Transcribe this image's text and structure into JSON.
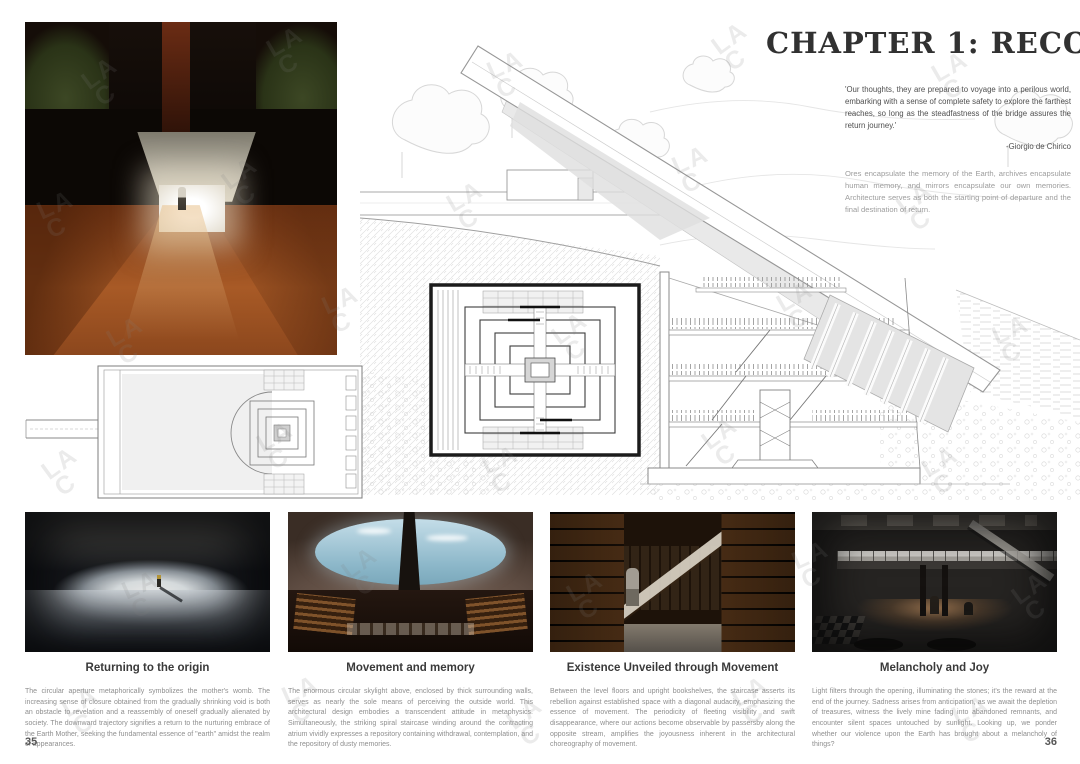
{
  "header": {
    "title": "CHAPTER 1: RECORD",
    "quote": "'Our thoughts, they are prepared to voyage into a perilous world, embarking with a sense of complete safety to explore the farthest reaches, so long as the steadfastness of the bridge assures the return journey.'",
    "attribution": "-Giorgio de Chirico",
    "intro": "Ores encapsulate the memory of the Earth, archives encapsulate human memory, and mirrors encapsulate our own memories. Architecture serves as both the starting point of departure and the final destination of return."
  },
  "watermark": {
    "line1": "LA",
    "line2": "C"
  },
  "pages": {
    "left": "35",
    "right": "36"
  },
  "sections": [
    {
      "title": "Returning to the origin",
      "body": "The circular aperture metaphorically symbolizes the mother's womb. The increasing sense of closure obtained from the gradually shrinking void is both an obstacle to revelation and a reassembly of oneself gradually alienated by society. The downward trajectory signifies a return to the nurturing embrace of the Earth Mother, seeking the fundamental essence of \"earth\" amidst the realm of appearances."
    },
    {
      "title": "Movement and memory",
      "body": "The enormous circular skylight above, enclosed by thick surrounding walls, serves as nearly the sole means of perceiving the outside world. This architectural design embodies a transcendent attitude in metaphysics. Simultaneously, the striking spiral staircase winding around the contracting atrium vividly expresses a repository containing withdrawal, contemplation, and the repository of dusty memories."
    },
    {
      "title": "Existence Unveiled through Movement",
      "body": "Between the level floors and upright bookshelves, the staircase asserts its rebellion against established space with a diagonal audacity, emphasizing the essence of movement.  The periodicity of fleeting visibility and swift disappearance, where our actions become observable by passersby along the opposite stream, amplifies the joyousness inherent in the architectural choreography of movement."
    },
    {
      "title": "Melancholy and Joy",
      "body": "Light filters through the opening, illuminating the stones; it's the reward at the end of the journey. Sadness arises from anticipation, as we await the depletion of treasures, witness the lively mine fading into abandoned remnants, and encounter silent spaces untouched by sunlight. Looking up, we ponder whether our violence upon the Earth has brought about a melancholy of things?"
    }
  ]
}
